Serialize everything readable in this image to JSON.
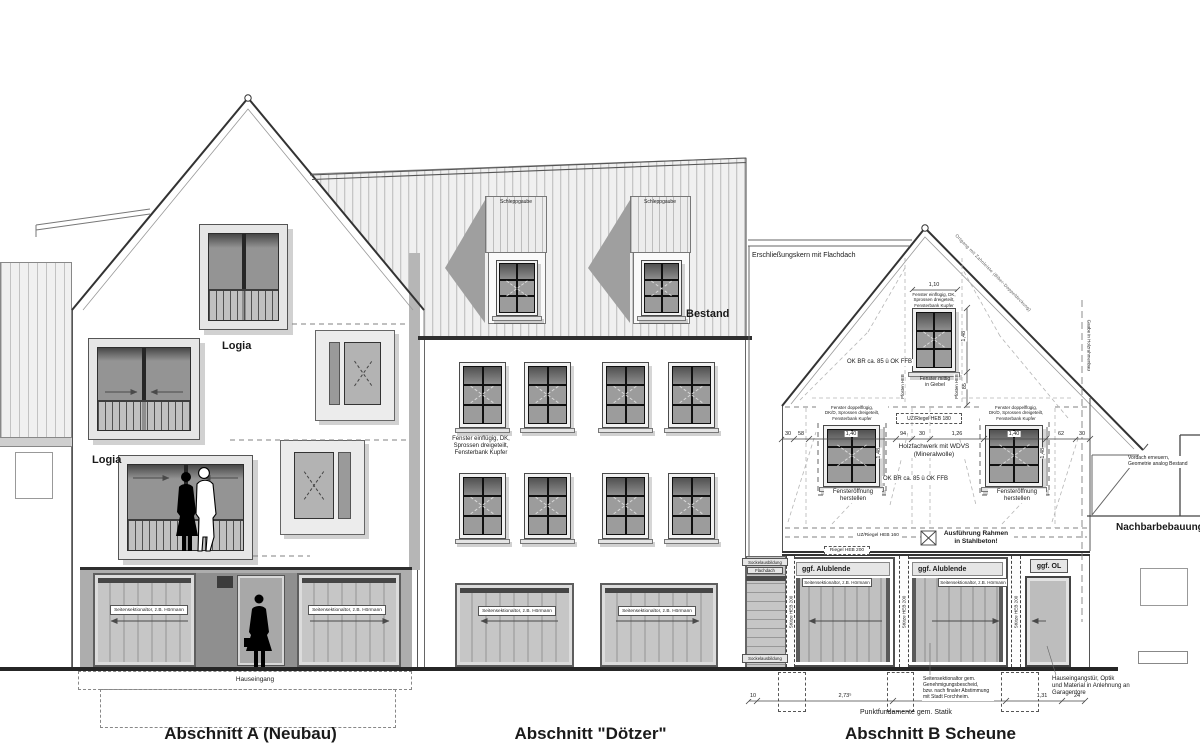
{
  "titles": {
    "a": "Abschnitt A (Neubau)",
    "doetzer": "Abschnitt \"Dötzer\"",
    "b": "Abschnitt B Scheune"
  },
  "a": {
    "logia_upper": "Logia",
    "logia_lower": "Logia",
    "garage_left": "Seitensektionaltor, z.B. Hörmann",
    "garage_right": "Seitensektionaltor, z.B. Hörmann",
    "entrance": "Hauseingang"
  },
  "d": {
    "dormer_left": "Schleppgaube",
    "dormer_right": "Schleppgaube",
    "bestand": "Bestand",
    "window_note": "Fenster einflügig, DK,\nSprossen dreigeteilt,\nFensterbank Kupfer",
    "garage_left": "Seitensektionaltor, z.B. Hörmann",
    "garage_right": "Seitensektionaltor, z.B. Hörmann"
  },
  "b": {
    "connector": "Erschließungskern mit Flachdach",
    "roof_edge": "Ortgang mit Zahnleiste (Biber-Doppeldeckung)",
    "gaube": "Gaube in Holzrahmenbau",
    "gable_dim_w": "1,10",
    "gable_window_note": "Fenster einflügig, DK,\nSprossen dreigeteilt,\nFensterbank Kupfer",
    "gable_ok": "OK BR ca. 85 ü OK FFB",
    "gable_center": "Fenster mittig\nin Giebel",
    "gable_dim_h": "1,48",
    "gable_dim_sill": "85",
    "post_left": "Pfosten HEB",
    "post_right": "Pfosten HEB",
    "win_note_left": "Fenster doppelflügig,\nDK/D, Sprossen dreigeteilt,\nFensterbank Kupfer",
    "win_note_right": "Fenster doppelflügig,\nDK/D, Sprossen dreigeteilt,\nFensterbank Kupfer",
    "riegel_180": "UZ/Riegel HEB 180",
    "dims": [
      "30",
      "58",
      "1,40",
      "94",
      "30",
      "1,26",
      "1,40",
      "62",
      "30"
    ],
    "fachwerk": "Holzfachwerk mit WDVS\n(Mineralwolle)",
    "ok_ffb": "OK BR ca. 85 ü OK FFB",
    "open_left": "Fensteröffnung\nherstellen",
    "open_right": "Fensteröffnung\nherstellen",
    "dim_h_left": "1,48",
    "dim_h_right": "1,48",
    "riegel_160": "UZ/Riegel HEB 160",
    "stahlbeton": "Ausführung Rahmen\nin Stahlbeton!",
    "riegel_200": "Riegel HEB 200",
    "alublende_left": "ggf. Alublende",
    "alublende_right": "ggf. Alublende",
    "ol": "ggf. OL",
    "garage_left": "Seitensektionaltor, z.B. Hörmann",
    "garage_right": "Seitensektionaltor, z.B. Hörmann",
    "stuetze1": "Stütze HEB 200",
    "stuetze2": "Stütze HEB 200",
    "stuetze3": "Stütze HEB 200",
    "sockel_top": "Sockelausbildung",
    "flachdach": "Flachdach",
    "sockel_bottom": "Sockelausbildung",
    "found_dims": [
      "10",
      "2,73⁵",
      "2,72⁵",
      "1,31",
      "24"
    ],
    "tor_note": "Seitensektionaltor gem.\nGenehmigungsbescheid,\nbzw. nach finaler Abstimmung\nmit Stadt Forchheim.",
    "punkt": "Punktfundamente gem. Statik",
    "tuer_note": "Hauseingangstür, Optik\nund Material in Anlehnung an\nGaragentore",
    "vordach": "Vordach erneuern,\nGeometrie analog Bestand",
    "nachbar": "Nachbarbebauung"
  }
}
